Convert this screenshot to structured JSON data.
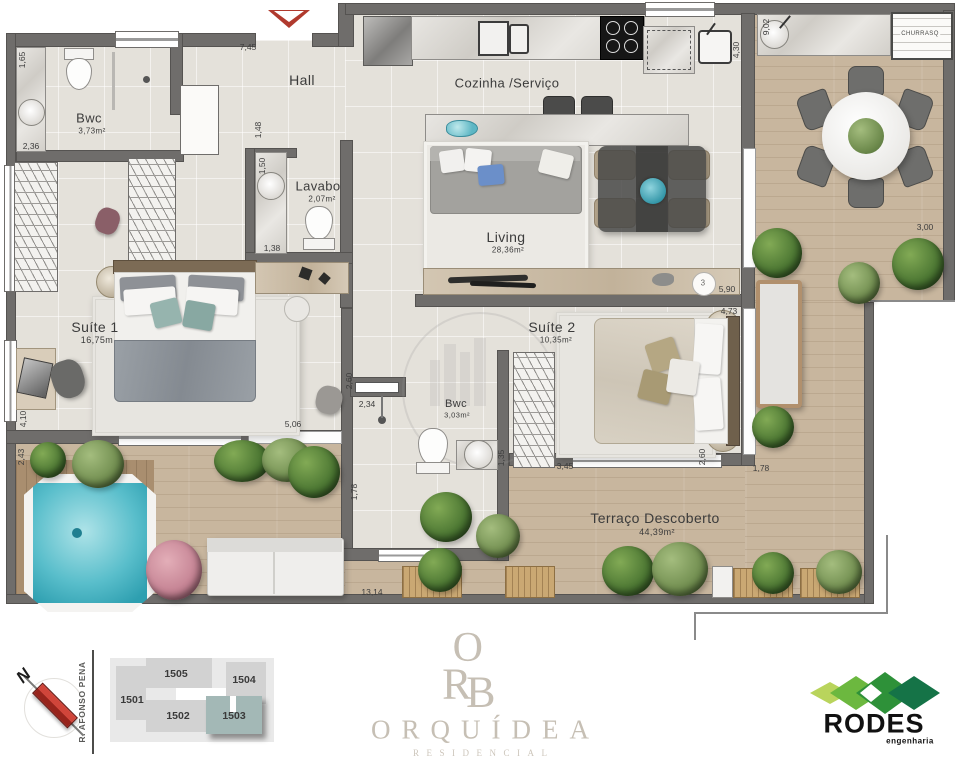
{
  "plan": {
    "rooms": {
      "bwc1": {
        "label": "Bwc",
        "area": "3,73m²"
      },
      "hall": {
        "label": "Hall"
      },
      "cozinha": {
        "label": "Cozinha /Serviço"
      },
      "lavabo": {
        "label": "Lavabo",
        "area": "2,07m²"
      },
      "living": {
        "label": "Living",
        "area": "28,36m²"
      },
      "suite1": {
        "label": "Suíte 1",
        "area": "16,75m"
      },
      "suite2": {
        "label": "Suíte 2",
        "area": "10,35m²"
      },
      "bwc2": {
        "label": "Bwc",
        "area": "3,03m²"
      },
      "terraco": {
        "label": "Terraço Descoberto",
        "area": "44,39m²"
      },
      "churrasqueira": {
        "label": "CHURRASQ"
      }
    },
    "dims": {
      "d745": "7,45",
      "d165": "1,65",
      "d236": "2,36",
      "d148": "1,48",
      "d150": "1,50",
      "d138": "1,38",
      "d902": "9,02",
      "d430": "4,30",
      "d300": "3,00",
      "d590": "5,90",
      "d473": "4,73",
      "d260a": "2,60",
      "d178a": "1,78",
      "d345": "3,45",
      "d135": "1,35",
      "d234": "2,34",
      "d260b": "2,60",
      "d506": "5,06",
      "d410": "4,10",
      "d243": "2,43",
      "d178b": "1,78",
      "d1314": "13,14"
    },
    "callout": "3"
  },
  "footer": {
    "north_label": "N",
    "street": "R. AFONSO PENA",
    "units": {
      "u1501": "1501",
      "u1502": "1502",
      "u1503": "1503",
      "u1504": "1504",
      "u1505": "1505"
    },
    "brand": {
      "mono_o": "O",
      "mono_r": "R",
      "mono_b": "B",
      "name": "ORQUÍDEA",
      "subtitle": "RESIDENCIAL"
    },
    "builder": {
      "name": "RODES",
      "subtitle": "engenharia"
    }
  },
  "colors": {
    "wall": "#6f6d6b",
    "accent_red": "#b03a2e",
    "terrace_wood": "#c8b69e",
    "highlighted_unit": "#a3b8b6",
    "brand_gray": "#c6bfb4",
    "builder_green": "#2e9139"
  }
}
